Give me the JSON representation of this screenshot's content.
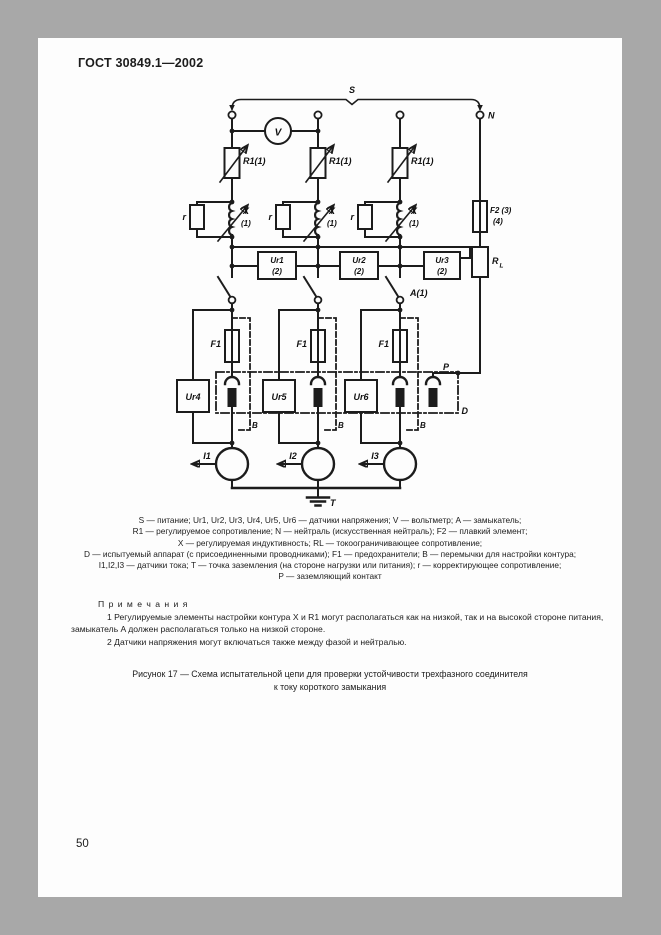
{
  "page": {
    "standard": "ГОСТ 30849.1—2002",
    "number": "50"
  },
  "diagram": {
    "labels": {
      "s": "S",
      "n": "N",
      "v": "V",
      "r1": "R1(1)",
      "r_corr": "r",
      "x": "X",
      "paren1": "(1)",
      "ur1": "Ur1",
      "ur2": "Ur2",
      "ur3": "Ur3",
      "paren2": "(2)",
      "f2": "F2 (3)",
      "f2b": "(4)",
      "rl_main": "R",
      "rl_sub": "L",
      "a": "A(1)",
      "f1": "F1",
      "b": "B",
      "p": "P",
      "d": "D",
      "t": "T"
    },
    "pole_sensors": [
      "Ur4",
      "Ur5",
      "Ur6"
    ],
    "current_sensors": [
      "I1",
      "I2",
      "I3"
    ]
  },
  "legend": {
    "lines": [
      "S — питание; Ur1, Ur2, Ur3, Ur4, Ur5, Ur6 — датчики напряжения; V — вольтметр; A — замыкатель;",
      "R1 — регулируемое сопротивление; N — нейтраль (искусственная нейтраль); F2 — плавкий элемент;",
      "X — регулируемая индуктивность; RL — токоограничивающее сопротивление;",
      "D — испытуемый аппарат (с присоединенными проводниками); F1 — предохранители; B — перемычки для настройки контура;",
      "I1,I2,I3 — датчики тока; T — точка заземления (на стороне нагрузки или питания); r — корректирующее сопротивление;",
      "P — заземляющий контакт"
    ]
  },
  "notes": {
    "heading": "П р и м е ч а н и я",
    "items": [
      "1 Регулируемые элементы настройки контура X и R1 могут располагаться как на низкой, так и на высокой стороне питания, замыкатель A должен располагаться только на низкой стороне.",
      "2 Датчики напряжения могут включаться также между фазой и нейтралью."
    ]
  },
  "caption": {
    "line1": "Рисунок 17 — Схема испытательной цепи для проверки устойчивости трехфазного соединителя",
    "line2": "к току короткого замыкания"
  },
  "colors": {
    "page_background": "#fdfdfd",
    "surround": "#a8a8a8",
    "ink": "#1c1c1c"
  }
}
